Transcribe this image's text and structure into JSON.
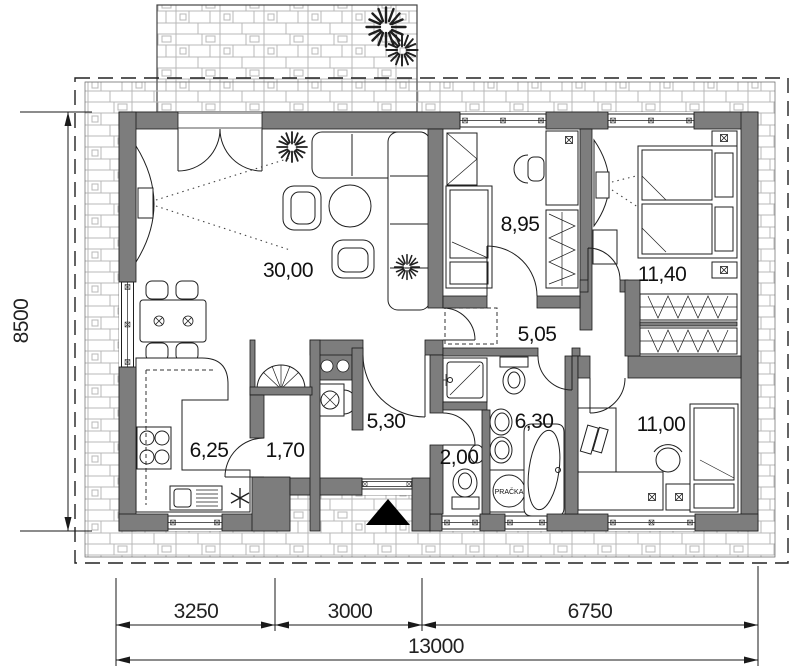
{
  "drawing": {
    "rooms": {
      "living": "30,00",
      "bedroom_top": "8,95",
      "bedroom_master": "11,40",
      "hallway": "5,05",
      "entrance_hall": "5,30",
      "bathroom": "6,30",
      "wc": "2,00",
      "kitchen": "6,25",
      "pantry": "1,70",
      "bedroom_right": "11,00"
    },
    "appliances": {
      "washing_machine": "PRAČKA"
    },
    "dimensions": {
      "height_total": "8500",
      "width_seg_1": "3250",
      "width_seg_2": "3000",
      "width_seg_3": "6750",
      "width_total": "13000"
    },
    "colors": {
      "wall": "#7d7d7d",
      "line": "#1a1a1a",
      "paving": "#b8b8b8"
    }
  }
}
